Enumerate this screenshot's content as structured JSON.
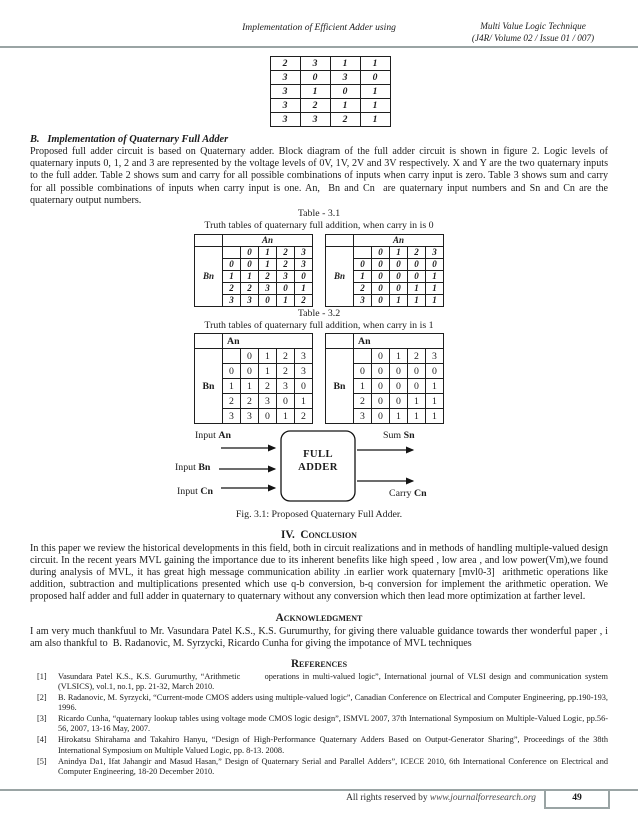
{
  "header": {
    "running_title": "Implementation of Efficient Adder using",
    "journal_line1": "Multi Value Logic Technique",
    "journal_line2": "(J4R/ Volume 02 / Issue 01 / 007)"
  },
  "top_table": {
    "rows": [
      [
        "2",
        "3",
        "1",
        "1"
      ],
      [
        "3",
        "0",
        "3",
        "0"
      ],
      [
        "3",
        "1",
        "0",
        "1"
      ],
      [
        "3",
        "2",
        "1",
        "1"
      ],
      [
        "3",
        "3",
        "2",
        "1"
      ]
    ]
  },
  "section_b": {
    "heading": "B.   Implementation of Quaternary Full Adder",
    "body": "Proposed full adder circuit is based on Quaternary adder. Block diagram of the full adder circuit is shown in figure 2. Logic levels of quaternary inputs 0, 1, 2 and 3 are represented by the voltage levels of 0V, 1V, 2V and 3V respectively. X and Y are the two quaternary inputs to the full adder. Table 2 shows sum and carry for all possible combinations of inputs when carry input is zero. Table 3 shows sum and carry for all possible combinations of inputs when carry input is one. An,  Bn and Cn  are quaternary input numbers and Sn and Cn are the quaternary output numbers."
  },
  "table31": {
    "title": "Table - 3.1",
    "caption": "Truth tables of quaternary full addition, when carry in is 0",
    "col_header": "An",
    "row_header": "Bn",
    "col_indices": [
      "0",
      "1",
      "2",
      "3"
    ],
    "sum_rows": [
      [
        "0",
        "0",
        "1",
        "2",
        "3"
      ],
      [
        "1",
        "1",
        "2",
        "3",
        "0"
      ],
      [
        "2",
        "2",
        "3",
        "0",
        "1"
      ],
      [
        "3",
        "3",
        "0",
        "1",
        "2"
      ]
    ],
    "carry_rows": [
      [
        "0",
        "0",
        "0",
        "0",
        "0"
      ],
      [
        "1",
        "0",
        "0",
        "0",
        "1"
      ],
      [
        "2",
        "0",
        "0",
        "1",
        "1"
      ],
      [
        "3",
        "0",
        "1",
        "1",
        "1"
      ]
    ]
  },
  "table32": {
    "title": "Table - 3.2",
    "caption": "Truth tables of quaternary full addition, when carry in is 1",
    "col_header": "An",
    "row_header": "Bn",
    "col_indices": [
      "0",
      "1",
      "2",
      "3"
    ],
    "sum_rows": [
      [
        "0",
        "0",
        "1",
        "2",
        "3"
      ],
      [
        "1",
        "1",
        "2",
        "3",
        "0"
      ],
      [
        "2",
        "2",
        "3",
        "0",
        "1"
      ],
      [
        "3",
        "3",
        "0",
        "1",
        "2"
      ]
    ],
    "carry_rows": [
      [
        "0",
        "0",
        "0",
        "0",
        "0"
      ],
      [
        "1",
        "0",
        "0",
        "0",
        "1"
      ],
      [
        "2",
        "0",
        "0",
        "1",
        "1"
      ],
      [
        "3",
        "0",
        "1",
        "1",
        "1"
      ]
    ]
  },
  "figure": {
    "box_line1": "FULL",
    "box_line2": "ADDER",
    "inputs": [
      {
        "prefix": "Input ",
        "var": "An"
      },
      {
        "prefix": "Input ",
        "var": "Bn"
      },
      {
        "prefix": "Input ",
        "var": "Cn"
      }
    ],
    "outputs": [
      {
        "prefix": "Sum ",
        "var": "Sn"
      },
      {
        "prefix": "Carry ",
        "var": "Cn"
      }
    ],
    "caption": "Fig. 3.1: Proposed Quaternary Full Adder."
  },
  "conclusion": {
    "heading": "IV.  Conclusion",
    "body": "In this paper we review the historical developments in this field, both in circuit realizations and in methods of handling multiple-valued design circuit. In the recent years MVL gaining the importance due to its inherent benefits like high speed , low area , and low power(Vm),we found during analysis of MVL, it has great high message communication ability .in earlier work quaternary [mvl0-3]  arithmetic operations like addition, subtraction and multiplications presented which use q-b conversion, b-q conversion for implement the arithmetic operation. We proposed half adder and full adder in quaternary to quaternary without any conversion which then lead more optimization at farther level."
  },
  "acknowledgment": {
    "heading": "Acknowledgment",
    "body": "I am very much thankfuul to Mr. Vasundara Patel K.S., K.S. Gurumurthy, for giving there valuable guidance towards ther wonderful paper , i am also thankful to  B. Radanovic, M. Syrzycki, Ricardo Cunha for giving the impotance of MVL techniques"
  },
  "references": {
    "heading": "References",
    "items": [
      {
        "num": "[1]",
        "text": "Vasundara Patel K.S., K.S. Gurumurthy, “Arithmetic       operations in multi-valued logic”, International journal of VLSI design and communication system (VLSICS), vol.1, no.1, pp. 21-32, March 2010."
      },
      {
        "num": "[2]",
        "text": "B. Radanovic, M. Syrzycki, “Current-mode CMOS adders using multiple-valued logic”, Canadian Conference on Electrical and Computer Engineering, pp.190-193, 1996."
      },
      {
        "num": "[3]",
        "text": "Ricardo Cunha, “quaternary lookup tables using voltage mode CMOS logic design”, ISMVL 2007, 37th International Symposium on Multiple-Valued Logic, pp.56-56, 2007, 13-16 May, 2007."
      },
      {
        "num": "[4]",
        "text": "Hirokatsu Shirahama and Takahiro Hanyu, “Design of High-Performance Quaternary Adders Based on Output-Generator Sharing”, Proceedings of the 38th International Symposium on Multiple Valued Logic, pp. 8-13. 2008."
      },
      {
        "num": "[5]",
        "text": "Anindya Da1, Ifat Jahangir and Masud Hasan,” Design of Quaternary Serial and Parallel Adders”, ICECE 2010, 6th International Conference on Electrical and Computer Engineering, 18-20 December 2010."
      }
    ]
  },
  "footer": {
    "rights_prefix": "All rights reserved by ",
    "url": "www.journalforresearch.org",
    "page_number": "49"
  },
  "colors": {
    "rule_gray": "#9aa4a4",
    "text": "#1c1c1c"
  }
}
